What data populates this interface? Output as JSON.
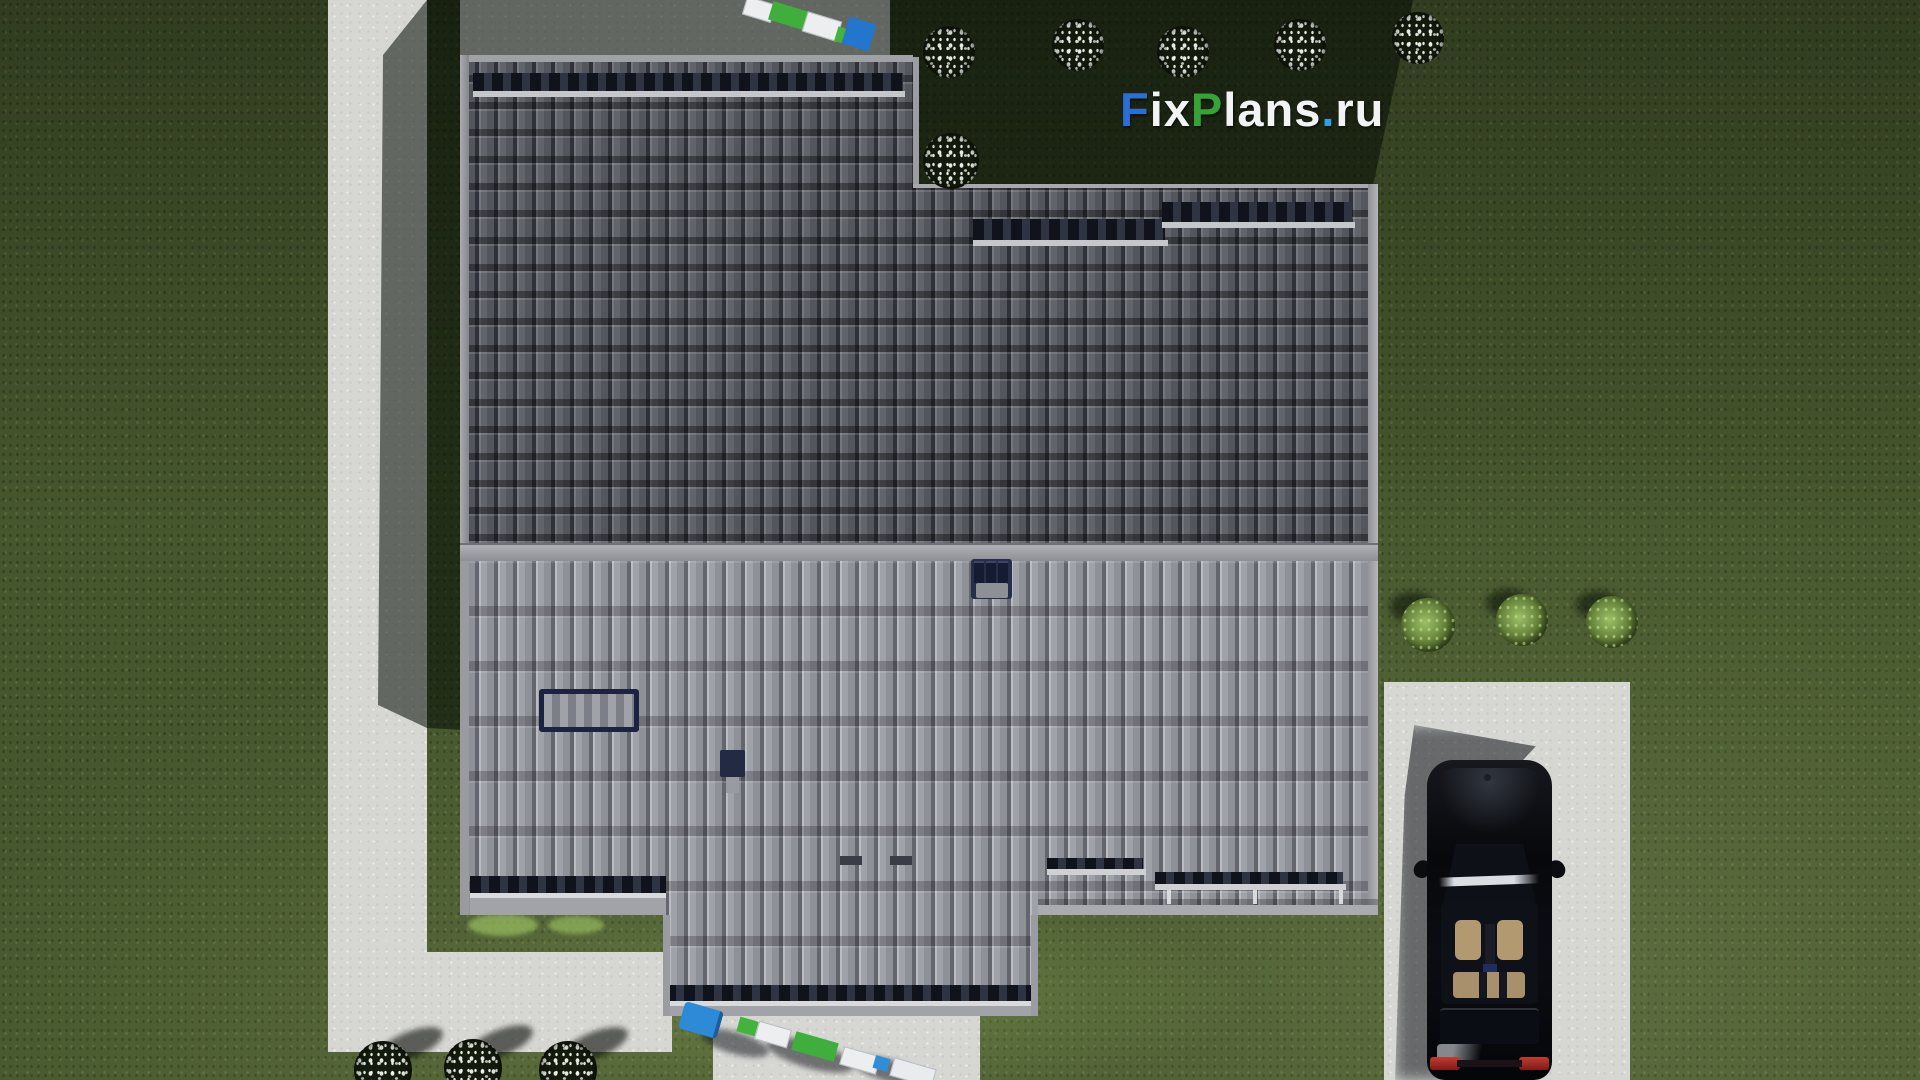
{
  "watermark": {
    "segments": [
      {
        "text": "F",
        "color": "#2b6fd6"
      },
      {
        "text": "ix",
        "color": "#f2f3f5"
      },
      {
        "text": "P",
        "color": "#35a335"
      },
      {
        "text": "lans",
        "color": "#f2f3f5"
      },
      {
        "text": ".",
        "color": "#2da0e8"
      },
      {
        "text": "ru",
        "color": "#f2f3f5"
      }
    ]
  },
  "palette": {
    "grass_lit": "#4e6134",
    "grass_shadowed": "#1d2714",
    "concrete_lit": "#d6d6d3",
    "concrete_shadowed": "#676d7a",
    "roof_upper_tile": "#62646c",
    "roof_upper_gap": "#303239",
    "roof_lower_tile": "#9a9ca4",
    "roof_lower_gap": "#64666e",
    "fascia": "#a2a3a8",
    "ridge_cap": "#a0a2a8",
    "gutter_white": "#d9dadc",
    "chimney_navy": "#272e4c",
    "car_body_black": "#0a0c11",
    "car_interior_tan": "#b2996f",
    "taillight_red": "#9c2020",
    "truck_blue": "#2d8ad6",
    "truck_green": "#3fae3c",
    "truck_white": "#eceef0",
    "bush_foliage_dark": "#131c0c",
    "bush_green_light": "#8fb35a",
    "flower_white": "#eef1ec"
  },
  "scene": {
    "objects": [
      "lawn",
      "house-roof-top-view",
      "garden-path",
      "driveway",
      "black-car",
      "delivery-truck-top",
      "delivery-truck-bottom",
      "flowering-shrubs",
      "green-shrubs",
      "chimney",
      "roof-window",
      "roof-vent"
    ]
  }
}
